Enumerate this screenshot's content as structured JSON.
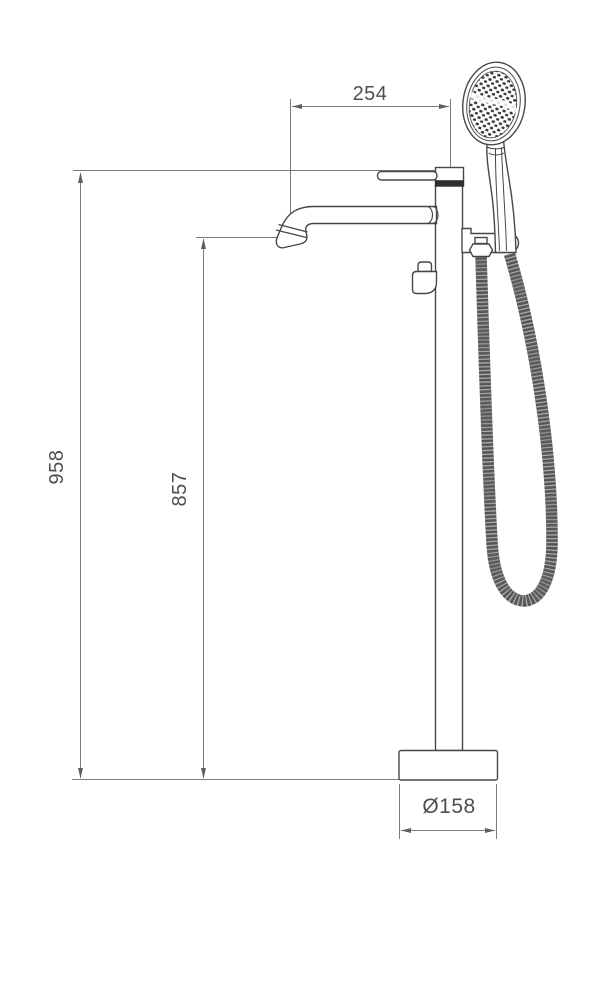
{
  "page": {
    "background": "#ffffff"
  },
  "drawing": {
    "type": "technical-dimension-diagram",
    "subject": "floor-standing-bathtub-mixer-with-hand-shower",
    "dimension_labels": {
      "spout_reach": "254",
      "overall_height": "958",
      "spout_height": "857",
      "base_diameter": "Ø158"
    },
    "colors": {
      "outline": "#474747",
      "dimension_line": "#7a7a7a",
      "dimension_text": "#4f4f4f",
      "dark_accent": "#2f2f2f",
      "hose": "#5a5a5a",
      "background": "#ffffff"
    },
    "components": [
      "hand-shower-head",
      "shower-handle",
      "shower-holder-bracket",
      "hose-connector-nut",
      "flexible-shower-hose",
      "mixer-lever-handle",
      "column-riser",
      "swivel-spout",
      "diverter-knob",
      "floor-base-plate"
    ]
  }
}
